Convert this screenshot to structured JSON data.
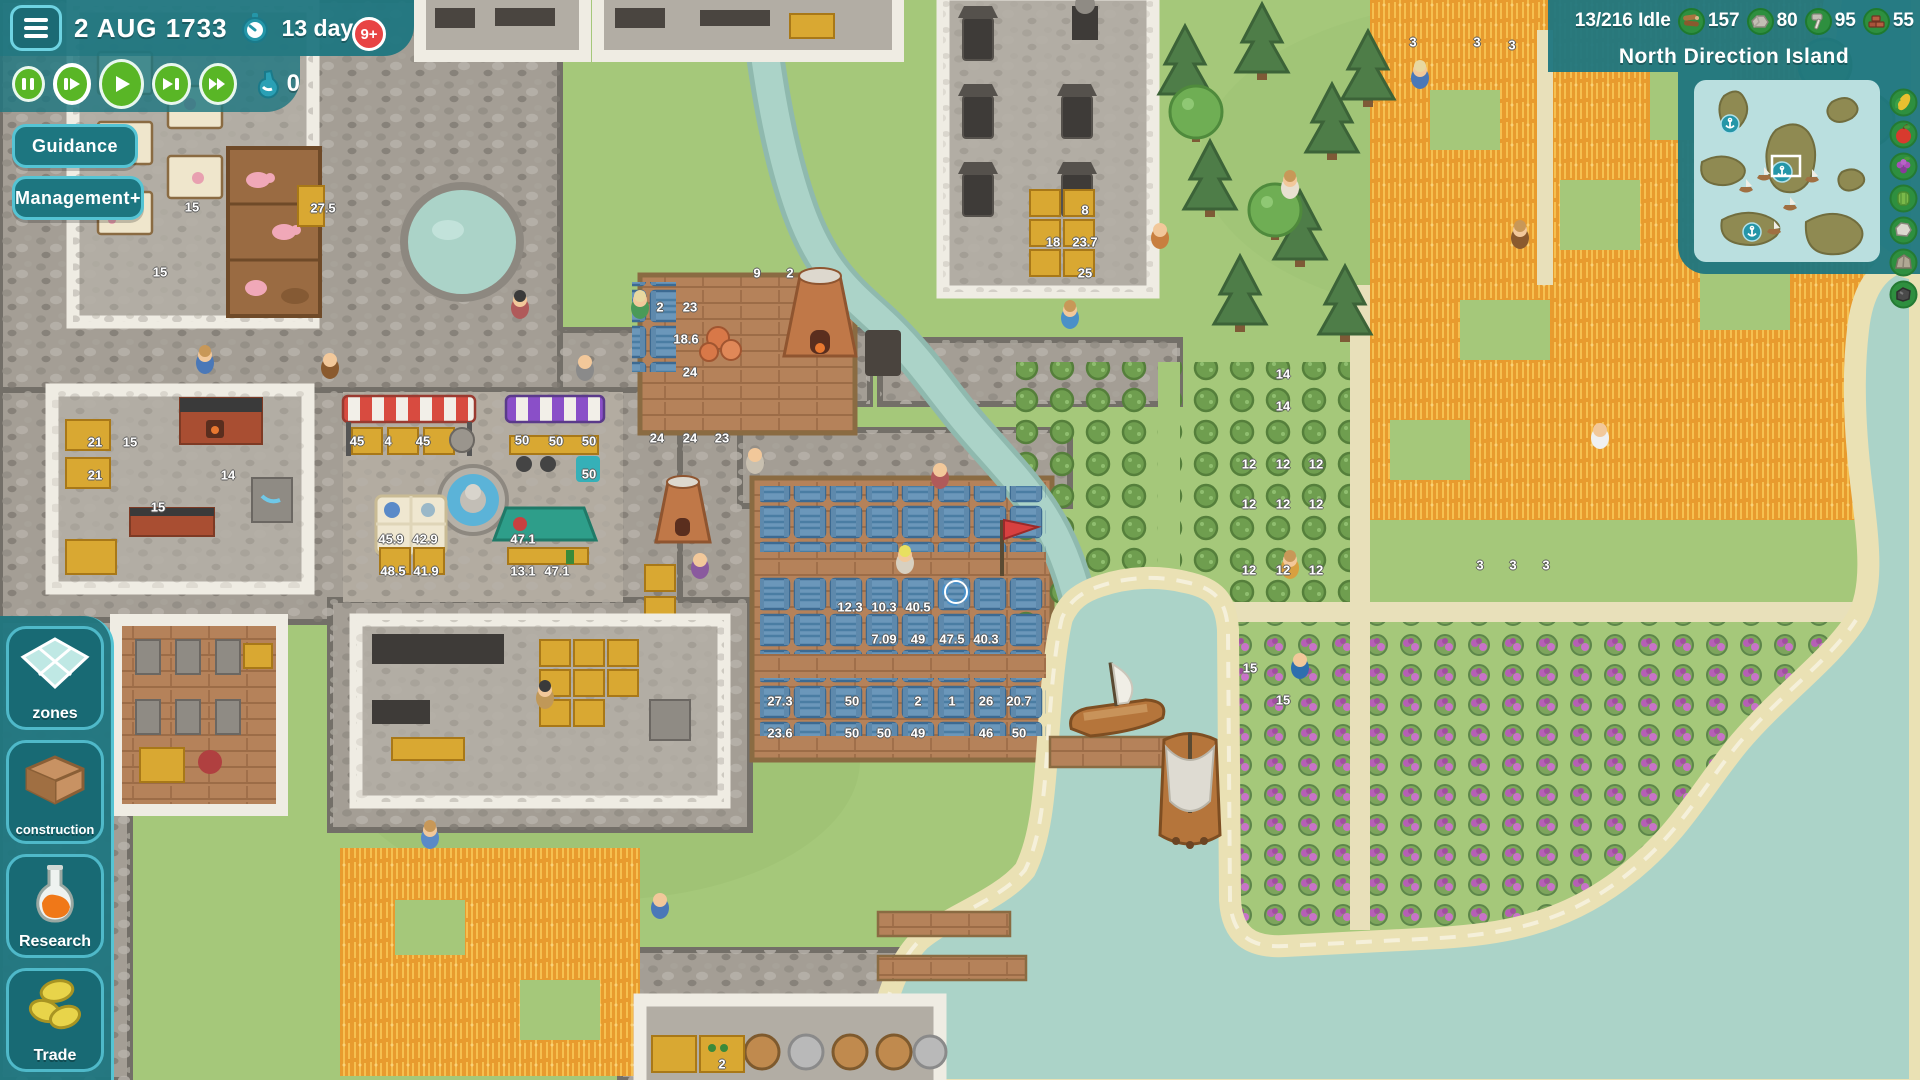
{
  "colors": {
    "panel": "#1f7680",
    "panel-border": "#55c4d4",
    "accent-green": "#59b626",
    "badge-red": "#e84444",
    "water": "#abd3c8",
    "sand": "#eae1b4",
    "grass": "#a5c87a",
    "stone": "#a49e95",
    "wood-floor": "#b5825a",
    "wheat": "#e89b2e",
    "grape": "#b55fb5",
    "crate-blue": "#6b97ba"
  },
  "hud": {
    "date": "2 AUG 1733",
    "timer_label": "13 days",
    "badge": "9+",
    "brew_value": "0",
    "guidance_label": "Guidance",
    "management_label": "Management+",
    "speed_controls": [
      {
        "name": "pause"
      },
      {
        "name": "play-slow"
      },
      {
        "name": "play"
      },
      {
        "name": "play-fast"
      },
      {
        "name": "play-fastest"
      }
    ]
  },
  "topbar": {
    "idle": "13/216 Idle",
    "resources": [
      {
        "name": "wood",
        "value": "157"
      },
      {
        "name": "stone",
        "value": "80"
      },
      {
        "name": "tools",
        "value": "95"
      },
      {
        "name": "bricks",
        "value": "55"
      }
    ],
    "island_name": "North Direction Island"
  },
  "minimap": {
    "anchor_ports": 3,
    "ship_markers": 5,
    "viewport_marker": "white-rect"
  },
  "rail_icons": [
    {
      "name": "corn"
    },
    {
      "name": "apple"
    },
    {
      "name": "grapes"
    },
    {
      "name": "cabbage"
    },
    {
      "name": "stone"
    },
    {
      "name": "boulder"
    },
    {
      "name": "coal"
    }
  ],
  "sidebar": [
    {
      "label": "zones",
      "icon": "zone-grid"
    },
    {
      "label": "construction",
      "icon": "room-corner"
    },
    {
      "label": "Research",
      "icon": "flask-orange"
    },
    {
      "label": "Trade",
      "icon": "coins"
    }
  ],
  "map_labels": [
    {
      "t": "15",
      "x": 192,
      "y": 207
    },
    {
      "t": "15",
      "x": 160,
      "y": 272
    },
    {
      "t": "27.5",
      "x": 323,
      "y": 208
    },
    {
      "t": "21",
      "x": 95,
      "y": 442
    },
    {
      "t": "15",
      "x": 130,
      "y": 442
    },
    {
      "t": "21",
      "x": 95,
      "y": 475
    },
    {
      "t": "14",
      "x": 228,
      "y": 475
    },
    {
      "t": "15",
      "x": 158,
      "y": 507
    },
    {
      "t": "8",
      "x": 1085,
      "y": 210
    },
    {
      "t": "18",
      "x": 1053,
      "y": 242
    },
    {
      "t": "23.7",
      "x": 1085,
      "y": 242
    },
    {
      "t": "25",
      "x": 1085,
      "y": 273
    },
    {
      "t": "9",
      "x": 757,
      "y": 273
    },
    {
      "t": "2",
      "x": 790,
      "y": 273
    },
    {
      "t": "2",
      "x": 660,
      "y": 307
    },
    {
      "t": "23",
      "x": 690,
      "y": 307
    },
    {
      "t": "18.6",
      "x": 686,
      "y": 339
    },
    {
      "t": "24",
      "x": 690,
      "y": 372
    },
    {
      "t": "24",
      "x": 657,
      "y": 438
    },
    {
      "t": "24",
      "x": 690,
      "y": 438
    },
    {
      "t": "23",
      "x": 722,
      "y": 438
    },
    {
      "t": "45",
      "x": 357,
      "y": 441
    },
    {
      "t": "4",
      "x": 388,
      "y": 441
    },
    {
      "t": "45",
      "x": 423,
      "y": 441
    },
    {
      "t": "50",
      "x": 522,
      "y": 440
    },
    {
      "t": "50",
      "x": 556,
      "y": 441
    },
    {
      "t": "50",
      "x": 589,
      "y": 441
    },
    {
      "t": "50",
      "x": 589,
      "y": 474
    },
    {
      "t": "45.9",
      "x": 391,
      "y": 539
    },
    {
      "t": "42.9",
      "x": 425,
      "y": 539
    },
    {
      "t": "48.5",
      "x": 393,
      "y": 571
    },
    {
      "t": "41.9",
      "x": 426,
      "y": 571
    },
    {
      "t": "47.1",
      "x": 523,
      "y": 539
    },
    {
      "t": "13.1",
      "x": 523,
      "y": 571
    },
    {
      "t": "47.1",
      "x": 557,
      "y": 571
    },
    {
      "t": "12.3",
      "x": 850,
      "y": 607
    },
    {
      "t": "10.3",
      "x": 884,
      "y": 607
    },
    {
      "t": "40.5",
      "x": 918,
      "y": 607
    },
    {
      "t": "7.09",
      "x": 884,
      "y": 639
    },
    {
      "t": "49",
      "x": 918,
      "y": 639
    },
    {
      "t": "47.5",
      "x": 952,
      "y": 639
    },
    {
      "t": "40.3",
      "x": 986,
      "y": 639
    },
    {
      "t": "27.3",
      "x": 780,
      "y": 701
    },
    {
      "t": "50",
      "x": 852,
      "y": 701
    },
    {
      "t": "2",
      "x": 918,
      "y": 701
    },
    {
      "t": "1",
      "x": 952,
      "y": 701
    },
    {
      "t": "26",
      "x": 986,
      "y": 701
    },
    {
      "t": "20.7",
      "x": 1019,
      "y": 701
    },
    {
      "t": "23.6",
      "x": 780,
      "y": 733
    },
    {
      "t": "50",
      "x": 852,
      "y": 733
    },
    {
      "t": "50",
      "x": 884,
      "y": 733
    },
    {
      "t": "49",
      "x": 918,
      "y": 733
    },
    {
      "t": "46",
      "x": 986,
      "y": 733
    },
    {
      "t": "50",
      "x": 1019,
      "y": 733
    },
    {
      "t": "14",
      "x": 1283,
      "y": 374
    },
    {
      "t": "14",
      "x": 1283,
      "y": 406
    },
    {
      "t": "12",
      "x": 1249,
      "y": 464
    },
    {
      "t": "12",
      "x": 1283,
      "y": 464
    },
    {
      "t": "12",
      "x": 1316,
      "y": 464
    },
    {
      "t": "12",
      "x": 1249,
      "y": 504
    },
    {
      "t": "12",
      "x": 1283,
      "y": 504
    },
    {
      "t": "12",
      "x": 1316,
      "y": 504
    },
    {
      "t": "12",
      "x": 1249,
      "y": 570
    },
    {
      "t": "12",
      "x": 1283,
      "y": 570
    },
    {
      "t": "12",
      "x": 1316,
      "y": 570
    },
    {
      "t": "3",
      "x": 1413,
      "y": 42
    },
    {
      "t": "3",
      "x": 1477,
      "y": 42
    },
    {
      "t": "3",
      "x": 1512,
      "y": 45
    },
    {
      "t": "3",
      "x": 1480,
      "y": 565
    },
    {
      "t": "3",
      "x": 1513,
      "y": 565
    },
    {
      "t": "3",
      "x": 1546,
      "y": 565
    },
    {
      "t": "15",
      "x": 1250,
      "y": 668
    },
    {
      "t": "15",
      "x": 1283,
      "y": 700
    },
    {
      "t": "2",
      "x": 722,
      "y": 1064
    }
  ]
}
